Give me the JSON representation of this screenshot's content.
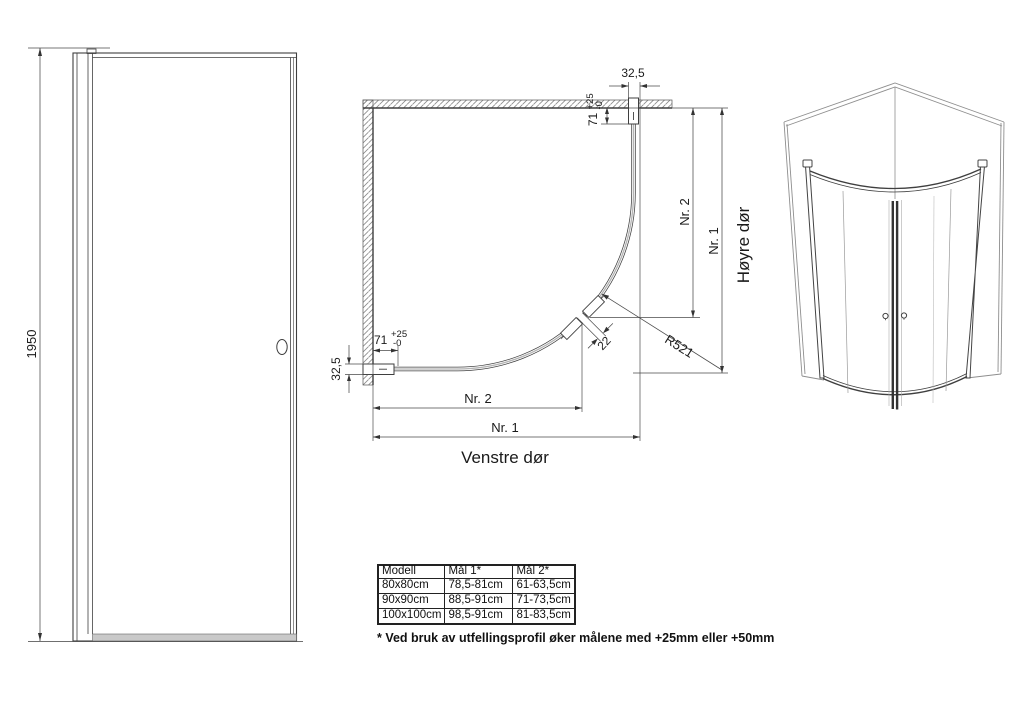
{
  "side_view": {
    "height_dim": "1950"
  },
  "plan_view": {
    "top_width_dim": "32,5",
    "top_offset_dim": {
      "value": "71",
      "plus": "+25",
      "minus": "-0"
    },
    "left_offset_dim": {
      "value": "71",
      "plus": "+25",
      "minus": "-0"
    },
    "left_width_dim": "32,5",
    "bottom_dim_inner": "Nr. 2",
    "bottom_dim_outer": "Nr. 1",
    "right_dim_inner": "Nr. 2",
    "right_dim_outer": "Nr. 1",
    "radius_label": "R521",
    "gap_dim": "22",
    "left_door_label": "Venstre dør",
    "right_door_label": "Høyre dør"
  },
  "table": {
    "headers": [
      "Modell",
      "Mål 1*",
      "Mål 2*"
    ],
    "rows": [
      [
        "80x80cm",
        "78,5-81cm",
        "61-63,5cm"
      ],
      [
        "90x90cm",
        "88,5-91cm",
        "71-73,5cm"
      ],
      [
        "100x100cm",
        "98,5-91cm",
        "81-83,5cm"
      ]
    ]
  },
  "footnote": "* Ved bruk av utfellingsprofil øker målene med +25mm eller +50mm",
  "colors": {
    "line": "#3f3f3f",
    "dim_line": "#4a4a4a",
    "glass_center": "#b3b3b3",
    "threshold_fill": "#c9c9c9",
    "text": "#1a1a1a"
  }
}
